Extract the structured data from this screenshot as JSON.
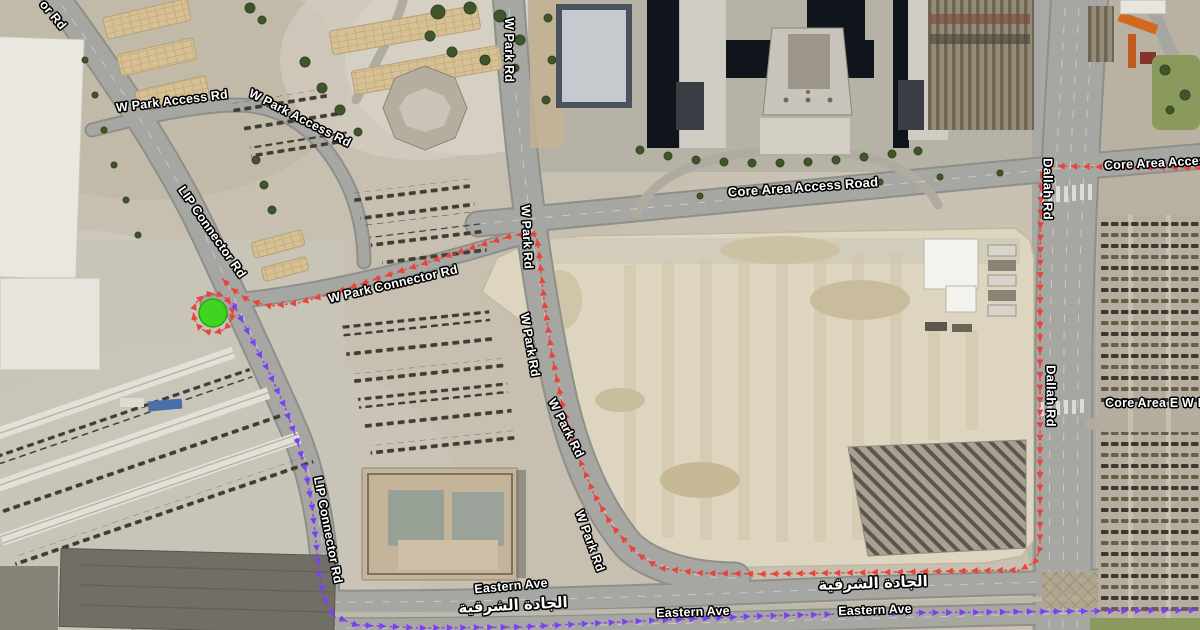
{
  "map": {
    "description": "Satellite navigation map with inbound and outbound route overlays",
    "marker": {
      "name": "destination-marker",
      "color": "#3ed41f",
      "edge": "#29a90e",
      "x": 213,
      "y": 313,
      "r": 14
    },
    "route_colors": {
      "inbound": "#e8443b",
      "outbound": "#7d3ff2"
    },
    "routes": [
      {
        "name": "inbound-route",
        "color": "#e8443b",
        "spacing": 12.5,
        "points": [
          [
            1204,
            168
          ],
          [
            1110,
            167
          ],
          [
            1048,
            166
          ],
          [
            1041,
            176
          ],
          [
            1040,
            300
          ],
          [
            1040,
            470
          ],
          [
            1040,
            548
          ],
          [
            1035,
            562
          ],
          [
            1020,
            570
          ],
          [
            900,
            572
          ],
          [
            760,
            574
          ],
          [
            700,
            573
          ],
          [
            660,
            568
          ],
          [
            636,
            553
          ],
          [
            612,
            526
          ],
          [
            594,
            494
          ],
          [
            578,
            456
          ],
          [
            563,
            408
          ],
          [
            552,
            355
          ],
          [
            544,
            300
          ],
          [
            539,
            252
          ],
          [
            536,
            234
          ],
          [
            515,
            235
          ],
          [
            478,
            246
          ],
          [
            432,
            261
          ],
          [
            382,
            277
          ],
          [
            334,
            293
          ],
          [
            298,
            303
          ],
          [
            270,
            306
          ],
          [
            248,
            300
          ],
          [
            231,
            288
          ],
          [
            220,
            276
          ]
        ]
      },
      {
        "name": "destination-ring",
        "color": "#e8443b",
        "spacing": 10.5,
        "circle": {
          "cx": 213,
          "cy": 313,
          "r": 19.5
        }
      },
      {
        "name": "outbound-route",
        "color": "#7d3ff2",
        "spacing": 13.5,
        "points": [
          [
            233,
            303
          ],
          [
            250,
            336
          ],
          [
            268,
            370
          ],
          [
            284,
            405
          ],
          [
            297,
            440
          ],
          [
            306,
            472
          ],
          [
            312,
            506
          ],
          [
            316,
            542
          ],
          [
            319,
            572
          ],
          [
            324,
            598
          ],
          [
            334,
            616
          ],
          [
            356,
            625
          ],
          [
            420,
            628
          ],
          [
            520,
            627
          ],
          [
            640,
            621
          ],
          [
            760,
            616
          ],
          [
            880,
            613
          ],
          [
            1000,
            612
          ],
          [
            1100,
            611
          ],
          [
            1204,
            610
          ]
        ]
      }
    ],
    "labels": [
      {
        "text": "or Rd",
        "x": 53,
        "y": 15,
        "rot": 50
      },
      {
        "text": "W Park Access Rd",
        "x": 172,
        "y": 101,
        "rot": -7
      },
      {
        "text": "W Park Access Rd",
        "x": 300,
        "y": 118,
        "rot": 27
      },
      {
        "text": "LIP Connector Rd",
        "x": 212,
        "y": 232,
        "rot": 55
      },
      {
        "text": "W Park Connector Rd",
        "x": 393,
        "y": 284,
        "rot": -13
      },
      {
        "text": "W Park Rd",
        "x": 509,
        "y": 50,
        "rot": 90
      },
      {
        "text": "W Park Rd",
        "x": 527,
        "y": 237,
        "rot": 87
      },
      {
        "text": "W Park Rd",
        "x": 530,
        "y": 345,
        "rot": 80
      },
      {
        "text": "W Park Rd",
        "x": 566,
        "y": 428,
        "rot": 63
      },
      {
        "text": "W Park Rd",
        "x": 590,
        "y": 541,
        "rot": 70
      },
      {
        "text": "Core Area Access Road",
        "x": 803,
        "y": 187,
        "rot": -4,
        "size": 13
      },
      {
        "text": "Core Area Acces",
        "x": 1155,
        "y": 163,
        "rot": -3
      },
      {
        "text": "Dallah Rd",
        "x": 1048,
        "y": 189,
        "rot": 90,
        "size": 13
      },
      {
        "text": "Dallah Rd",
        "x": 1051,
        "y": 396,
        "rot": 90,
        "size": 13
      },
      {
        "text": "Core Area E W R",
        "x": 1156,
        "y": 403,
        "rot": 0
      },
      {
        "text": "LIP Connector Rd",
        "x": 328,
        "y": 530,
        "rot": 79
      },
      {
        "text": "Eastern Ave",
        "x": 511,
        "y": 586,
        "rot": -5
      },
      {
        "text": "الجادة الشرقية",
        "x": 513,
        "y": 605,
        "rot": -3,
        "ar": true
      },
      {
        "text": "الجادة الشرقية",
        "x": 873,
        "y": 583,
        "rot": -2,
        "ar": true
      },
      {
        "text": "Eastern Ave",
        "x": 693,
        "y": 612,
        "rot": -2
      },
      {
        "text": "Eastern Ave",
        "x": 875,
        "y": 610,
        "rot": -2
      }
    ]
  }
}
